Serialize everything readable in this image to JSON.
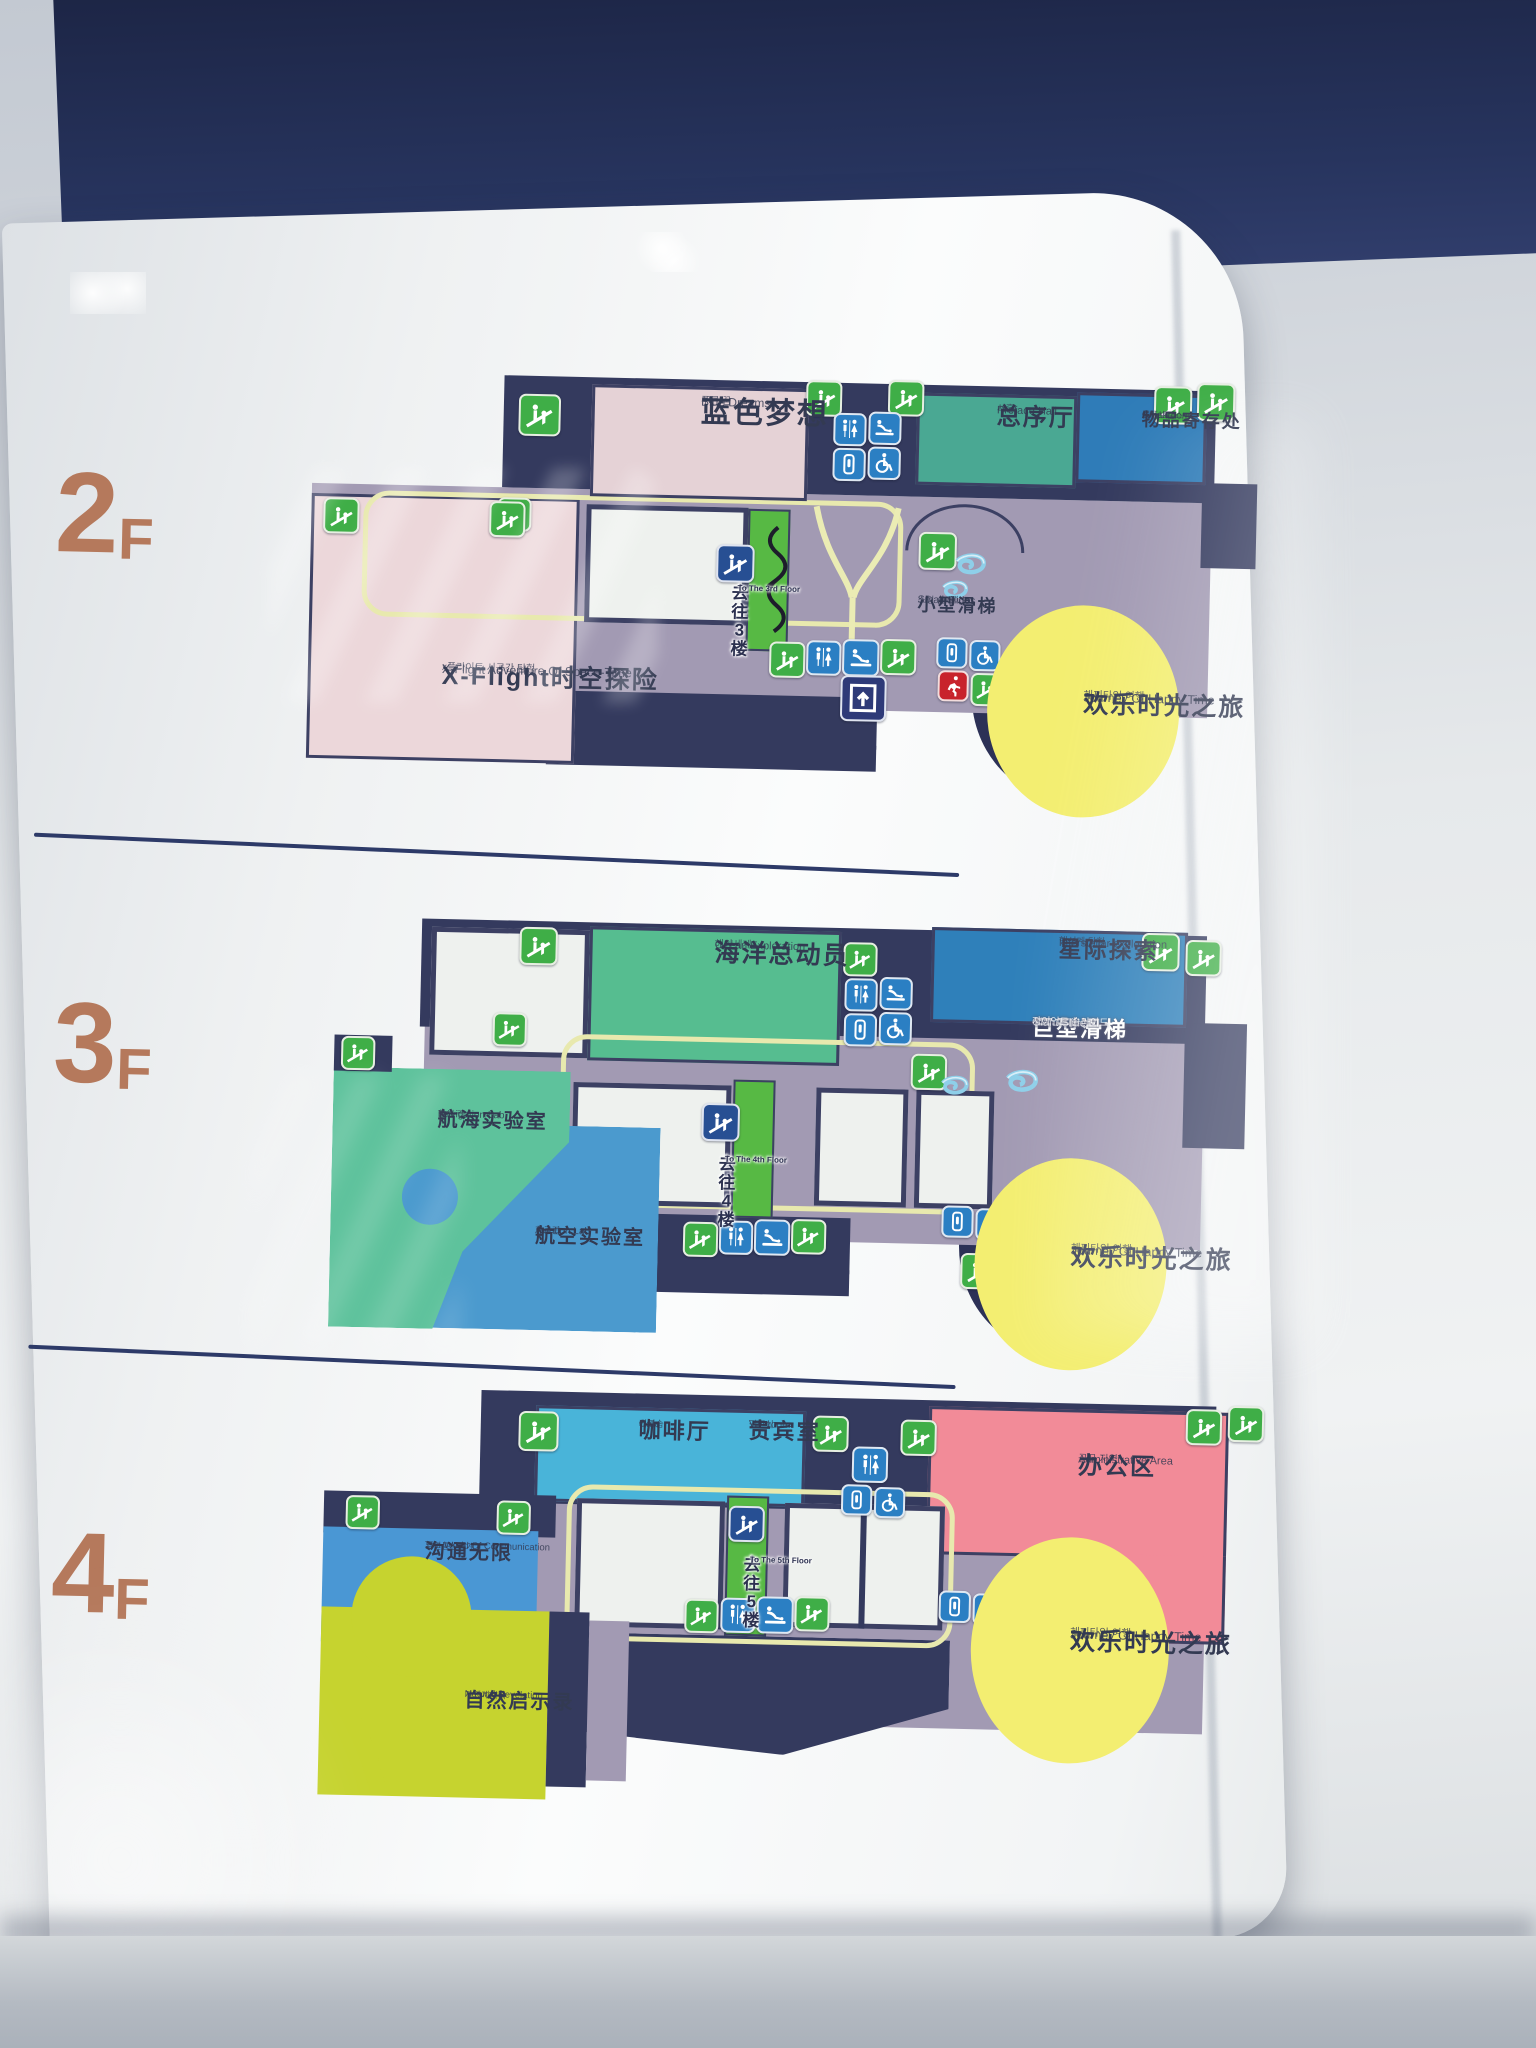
{
  "sign": {
    "type": "mall-floor-directory-lightbox"
  },
  "colors": {
    "floor_label": "#b5795c",
    "band_navy": "#232c4e",
    "wall_navy": "#3c4063",
    "corridor": "#a29ab3",
    "escalator_green": "#3fae47",
    "icon_blue": "#2b7fc3",
    "emergency_red": "#c8232c",
    "path_yellow": "#e8e9ae",
    "journey_yellow": "#f3ee71",
    "preface_teal": "#4aa893",
    "cloakroom_blue": "#2f7cb8",
    "pink_room": "#ecd7da",
    "ocean_green": "#56bd90",
    "interstellar_blue": "#2f80ba",
    "navigation_green": "#5ec29c",
    "aviation_blue": "#4b9ace",
    "cafe_blue": "#49b4d9",
    "admin_pink": "#f28b98",
    "communication_blue": "#4a97d4",
    "natural_green": "#c6d32f"
  },
  "icons": {
    "escalator-icon": "green square, white escalator with two figures",
    "toilet-icon": "blue square, man and woman figures",
    "baby-care-icon": "blue square, attendant at changing table",
    "squat-toilet-icon": "blue square, toilet pan outline",
    "wheelchair-icon": "blue square, accessible wheelchair symbol",
    "emergency-exit-icon": "red square, running figure",
    "elevator-icon": "navy square, up arrow in cab",
    "escalator-sign-icon": "dark blue square, escalator ramp",
    "spiral-slide-icon": "light blue spiral slide"
  },
  "floors": {
    "f2": {
      "num": "2",
      "suffix": "F",
      "blue_dreams": {
        "zh": "蓝色梦想",
        "en": "Blue Dreams",
        "ko": "푸른 꿈"
      },
      "preface_hall": {
        "zh": "总序厅",
        "en": "Preface Hall",
        "ko": "서홀"
      },
      "cloakroom": {
        "zh": "物品寄存处",
        "en": "Cloakroom",
        "ko": "물품보관소"
      },
      "x_flight": {
        "zh": "X-Flight时空探险",
        "en": "X-Flight Adventure Of Space-Time",
        "ko": "x플라이트 시공간 탐험"
      },
      "small_slides": {
        "zh": "小型滑梯",
        "en": "Small Slides",
        "ko": "소형 슬라이드"
      },
      "to_floor": {
        "zh": "去往3楼",
        "en": "To The 3rd Floor"
      },
      "journey": {
        "zh": "欢乐时光之旅",
        "en": "Journey Of Happy Time",
        "ko": "해피타임 여행"
      }
    },
    "f3": {
      "num": "3",
      "suffix": "F",
      "ocean": {
        "zh": "海洋总动员",
        "en": "Ocean Exploration",
        "ko": "해양세계"
      },
      "interstellar": {
        "zh": "星际探索",
        "en": "Interstellar exploration",
        "ko": "행성계 탐험"
      },
      "giant_slide": {
        "zh": "巨型滑梯",
        "en": "Giant Slide",
        "ko": "자이언트 슬라이드"
      },
      "navigation": {
        "zh": "航海实验室",
        "en": "Navigation Lab",
        "ko": "항해 랩"
      },
      "aviation": {
        "zh": "航空实验室",
        "en": "Aviation Lab",
        "ko": "항공랩"
      },
      "to_floor": {
        "zh": "去往4楼",
        "en": "To The 4th Floor"
      },
      "journey": {
        "zh": "欢乐时光之旅",
        "en": "Journey Of Happy Time",
        "ko": "해피타임 여행"
      }
    },
    "f4": {
      "num": "4",
      "suffix": "F",
      "cafe": {
        "zh": "咖啡厅",
        "en": "Cafe",
        "ko": "커피숍"
      },
      "vip": {
        "zh": "贵宾室",
        "en": "VIP room",
        "ko": "귀빈실"
      },
      "admin": {
        "zh": "办公区",
        "en": "Administrative Area",
        "ko": "근무 지역"
      },
      "communication": {
        "zh": "沟通无限",
        "en": "The World Of Communication",
        "ko": "무한통신세계"
      },
      "natural": {
        "zh": "自然启示录",
        "en": "Natural Revelation",
        "ko": "자연계시록"
      },
      "to_floor": {
        "zh": "去往5楼",
        "en": "To The 5th Floor"
      },
      "journey": {
        "zh": "欢乐时光之旅",
        "en": "Journey Of Happy Time",
        "ko": "해피타임 여행"
      }
    }
  }
}
